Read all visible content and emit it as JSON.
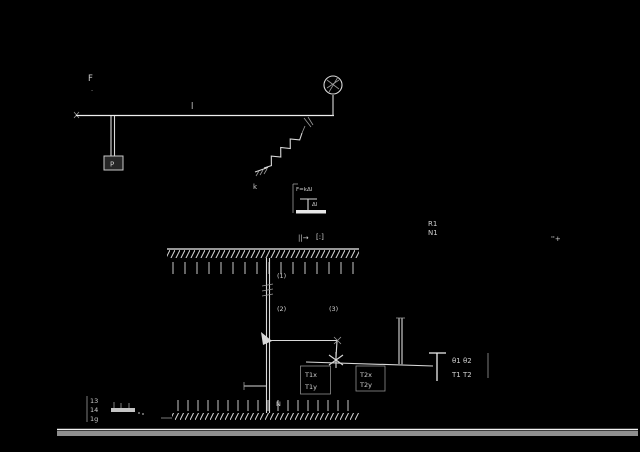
{
  "figure": {
    "bg": "#000000",
    "ink": "#d9d9d9",
    "bar_color": "#8f8f8f"
  },
  "top_diagram": {
    "force_label": "F",
    "force_sub": ".",
    "beam_length_label": "l",
    "weight_label": "P",
    "spring_const_label": "k",
    "inset_eq_line1": "F=kΔl",
    "inset_eq_line2": "Δl"
  },
  "lower_diagram": {
    "header_left": "||→",
    "header_right": "[:]",
    "rope_labels": [
      "(1)",
      "(2)",
      "(3)"
    ],
    "side_label_row1": "R1",
    "side_label_row2": "N1",
    "corner_note": "''+",
    "box1_line1": "T1x",
    "box1_line2": "T1y",
    "box2_line1": "T2x",
    "box2_line2": "T2y",
    "bracket_row1": "θ1 θ2",
    "bracket_row2": "T1 T2",
    "normal_label": "N",
    "footnote_rows": [
      "13",
      "14",
      "1g"
    ]
  }
}
